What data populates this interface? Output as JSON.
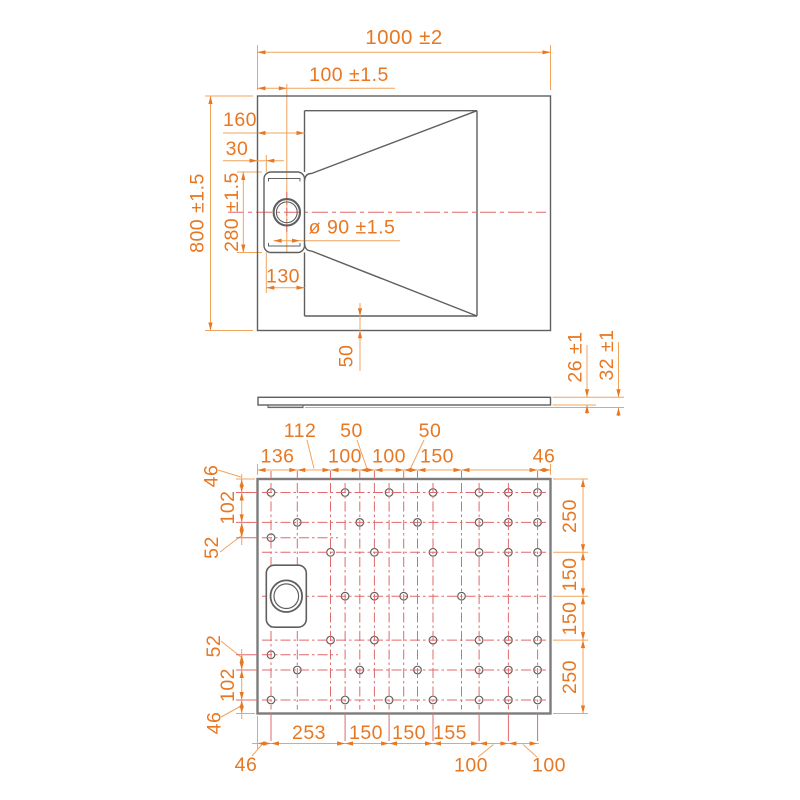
{
  "colors": {
    "dimension_orange": "#e87722",
    "extension_line_orange": "#f0a45c",
    "centerline_red": "#e0696b",
    "drawing_gray": "#5f5f5f"
  },
  "views": {
    "top": {
      "overall_width": "1000 ±2",
      "drain_center_offset": "100 ±1.5",
      "edge_to_basin": "160",
      "edge_to_drain": "30",
      "overall_depth": "800 ±1.5",
      "drain_recess_length": "280 ±1.5",
      "drain_diameter": "ø 90 ±1.5",
      "drain_recess_width": "130",
      "rim_width": "50"
    },
    "side": {
      "tray_thickness": "26 ±1",
      "total_height": "32 ±1"
    },
    "bottom": {
      "top_row": {
        "d136": "136",
        "d112": "112",
        "d100a": "100",
        "d50a": "50",
        "d100b": "100",
        "d50b": "50",
        "d150": "150",
        "d46": "46"
      },
      "left_top": {
        "d46": "46",
        "d102": "102",
        "d52": "52"
      },
      "left_bottom": {
        "d52": "52",
        "d102": "102",
        "d46": "46"
      },
      "right": {
        "d250a": "250",
        "d150a": "150",
        "d150b": "150",
        "d250b": "250"
      },
      "bottom_row": {
        "d46": "46",
        "d253": "253",
        "d150a": "150",
        "d150b": "150",
        "d155": "155",
        "d100a": "100",
        "d100b": "100"
      }
    }
  }
}
